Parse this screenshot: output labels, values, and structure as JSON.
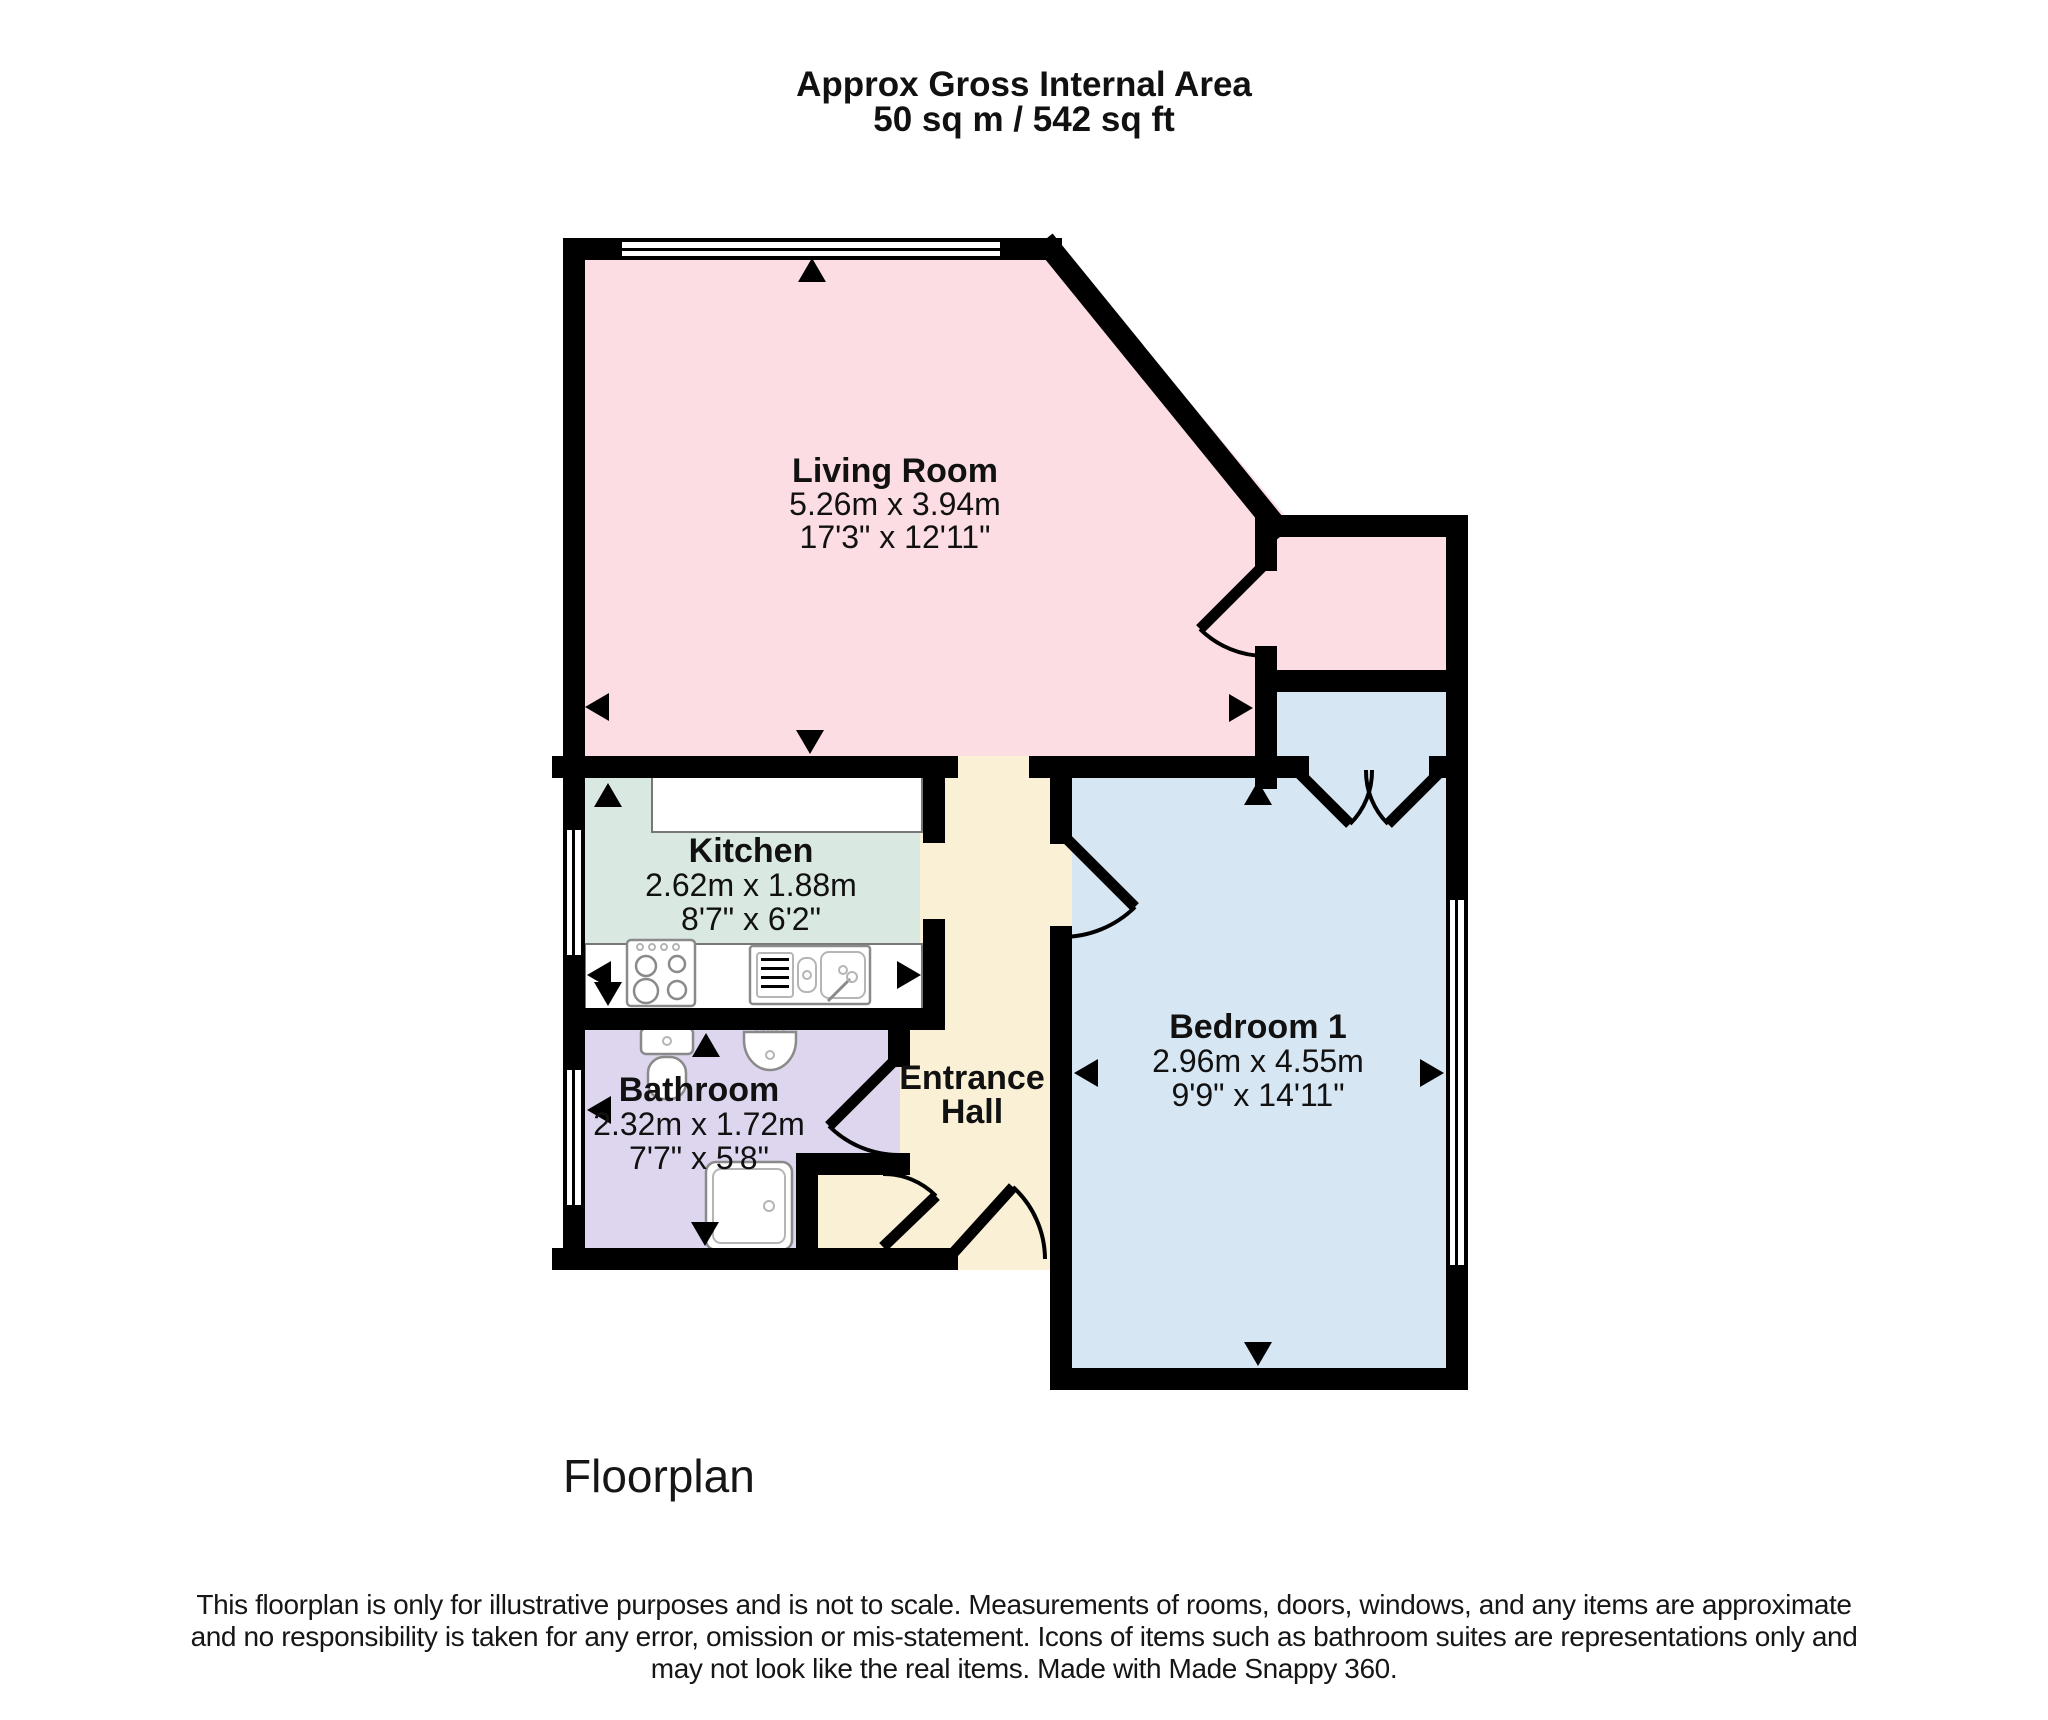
{
  "header": {
    "title_line1": "Approx Gross Internal Area",
    "title_line2": "50 sq m / 542 sq ft"
  },
  "rooms": {
    "living": {
      "name": "Living Room",
      "dim_metric": "5.26m x 3.94m",
      "dim_imperial": "17'3\" x 12'11\""
    },
    "kitchen": {
      "name": "Kitchen",
      "dim_metric": "2.62m x 1.88m",
      "dim_imperial": "8'7\" x 6'2\""
    },
    "bathroom": {
      "name": "Bathroom",
      "dim_metric": "2.32m x 1.72m",
      "dim_imperial": "7'7\" x 5'8\""
    },
    "entrance_hall": {
      "name_line1": "Entrance",
      "name_line2": "Hall"
    },
    "bedroom": {
      "name": "Bedroom 1",
      "dim_metric": "2.96m x 4.55m",
      "dim_imperial": "9'9\" x 14'11\""
    }
  },
  "footer": {
    "label": "Floorplan",
    "disclaimer_line1": "This floorplan is only for illustrative purposes and is not to scale. Measurements of rooms, doors, windows, and any items are approximate",
    "disclaimer_line2": "and no responsibility is taken for any error, omission or mis-statement. Icons of items such as bathroom suites are representations only and",
    "disclaimer_line3": "may not look like the real items. Made with Made Snappy 360."
  },
  "colors": {
    "living": "#fbdde3",
    "storage": "#fbdde3",
    "kitchen": "#d9e8e1",
    "bathroom": "#ded6ee",
    "hall": "#faf0d6",
    "bedroom": "#d6e6f3",
    "wall": "#000000"
  }
}
